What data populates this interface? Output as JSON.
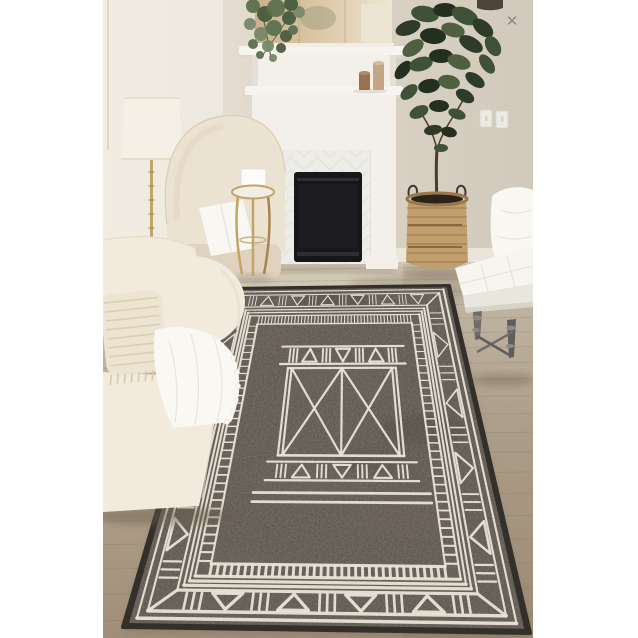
{
  "viewer": {
    "close_glyph": "✕"
  },
  "scene": {
    "setting": "bright neutral living room staged around a white two-tier fireplace mantel with mirror",
    "product": "dark taupe area rug with ivory tribal geometric pattern (triangle border, railroad band, central X medallion)",
    "objects": [
      "cream-sofa",
      "wingback-armchair",
      "floor-lamp",
      "gold-side-table",
      "fireplace",
      "mantel-mirror",
      "candles",
      "eucalyptus-plant",
      "fiddle-leaf-fig",
      "woven-basket-planter",
      "light-switches",
      "tufted-bench",
      "area-rug",
      "wood-floor"
    ]
  },
  "palette": {
    "wall_light": "#ece6da",
    "wall_mid": "#dbd3c6",
    "wall_dark": "#d1c9bb",
    "wall_bright": "#f6f2ea",
    "baseboard": "#ebe8dd",
    "base_shadow": "#c6bba8",
    "floor_far": "#d2c8b6",
    "floor_mid": "#b5a893",
    "floor_near": "#a08e78",
    "plank": "#6e5a48",
    "fireplace_white": "#f7f4ef",
    "fireplace_panel": "#f3f0ea",
    "fireplace_shadow": "#ddd8cf",
    "herringbone": "#edece8",
    "herringbone_line": "#dedcd7",
    "firebox": "#17171a",
    "firebox_trim": "#2d2d32",
    "firebox_inner": "#1d1d21",
    "mirror_l": "#c9b28c",
    "mirror_m": "#dcc9a8",
    "mirror_r": "#eee5d2",
    "mirror_frame": "#f0ede7",
    "mirror_seam": "#b9a27d",
    "reflect_white": "#ece4d2",
    "reflect_green": "#84896a",
    "sliver": "#4b4539",
    "euc1": "#5d7050",
    "euc2": "#77886a",
    "euc3": "#495b3e",
    "stem": "#5a6b4a",
    "fig_dark": "#24301f",
    "fig_mid": "#2e3b28",
    "fig_light": "#3f5136",
    "fig_lighter": "#4e6040",
    "trunk": "#4e3c2a",
    "basket": "#c19e6c",
    "basket_line": "#9a774b",
    "basket_zig": "#7e5f3b",
    "basket_inner": "#2a2318",
    "handle": "#3f3a31",
    "candle1": "#9a7150",
    "candle1_top": "#b08a64",
    "candle2": "#c2a685",
    "candle2_top": "#d4bc9c",
    "switch": "#eceae4",
    "switch_line": "#d7d3ca",
    "bench": "#f7f5f0",
    "bench_face": "#e9e6de",
    "bench_rail": "#d8d4ca",
    "bench_seam": "#e5e1d8",
    "chrome": "#6e6d69",
    "chrome_dark": "#5f5d59",
    "chrome_hl": "#8b8a85",
    "pillow": "#f9f7f2",
    "pillow_line": "#e7e3da",
    "sofa": "#f1eadd",
    "sofa_dark": "#e6dcca",
    "fringe_pillow": "#ede3d1",
    "fringe_line": "#d8c9ab",
    "blanket": "#faf8f3",
    "blanket_line": "#eae5da",
    "chair": "#ece2d2",
    "chair_line": "#d9cdb9",
    "chair_dark": "#dfd3c0",
    "lamp": "#f5f0e6",
    "lamp_line": "#e4dccb",
    "gold": "#c2a368",
    "gold_dark": "#a8854e",
    "table_top": "#f2eee6",
    "box": "#fcfbf8",
    "box_line": "#e3dfd5",
    "rug_bind": "#33302b",
    "rug_field": "#564f48",
    "rug_light": "#7a6f63",
    "rug_dark": "#3f3a35",
    "rug_line": "#eae4d8",
    "rug_speckle": "#ded6c6",
    "shadow": "#6b5c49",
    "close": "#8d8d8d"
  },
  "rug": {
    "pattern": {
      "triangle_cells_top": 12,
      "triangle_cells_bottom": 9,
      "triangle_cells_side": 9,
      "comb_ticks_top": 46,
      "comb_ticks_bottom": 34,
      "comb_ticks_side": 30,
      "medallion_cells": 7
    }
  }
}
